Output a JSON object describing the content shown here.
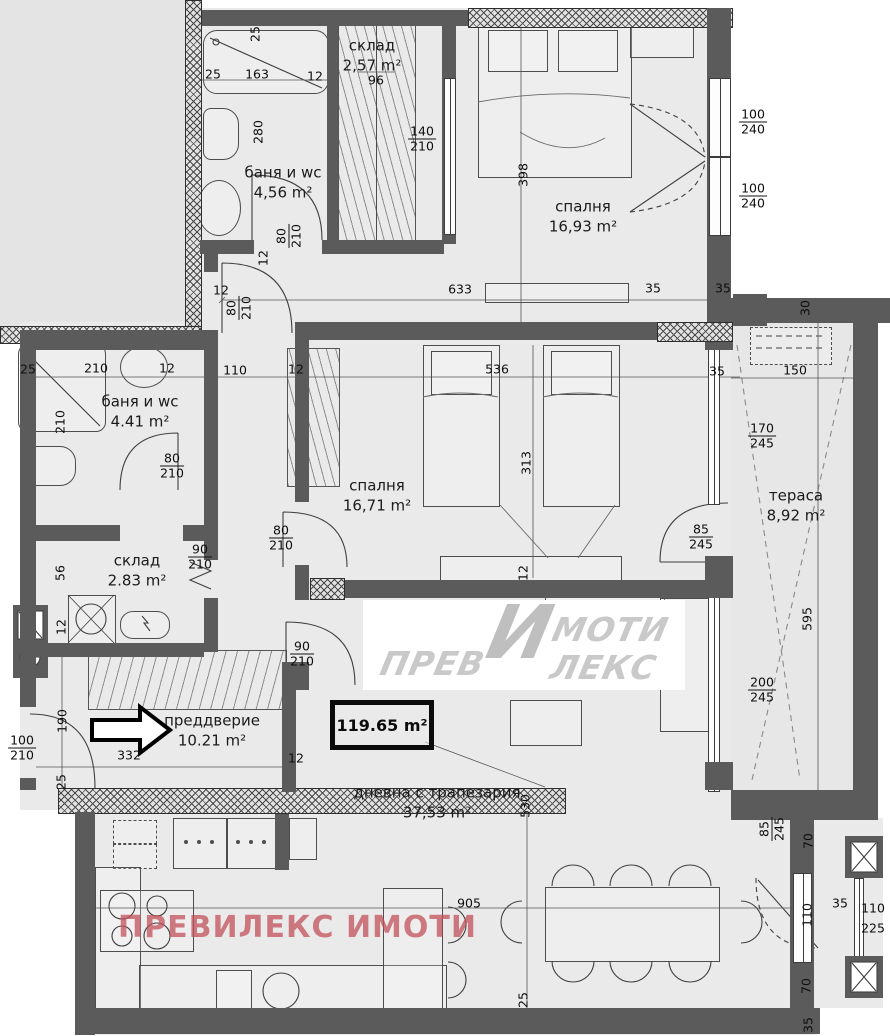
{
  "rooms": [
    {
      "label": "склад",
      "area": "2,57 m²"
    },
    {
      "label": "баня и wc",
      "area": "4,56 m²"
    },
    {
      "label": "спалня",
      "area": "16,93 m²"
    },
    {
      "label": "баня и wc",
      "area": "4.41 m²"
    },
    {
      "label": "спалня",
      "area": "16,71 m²"
    },
    {
      "label": "склад",
      "area": "2.83 m²"
    },
    {
      "label": "тераса",
      "area": "8,92 m²"
    },
    {
      "label": "преддверие",
      "area": "10.21 m²"
    },
    {
      "label": "дневна с трапезария",
      "area": "37,53 m²"
    }
  ],
  "badge": {
    "total_area": "119.65 m²"
  },
  "watermarks": {
    "logo": {
      "prev": "ПРЕВ",
      "big_i": "И",
      "moti": "МОТИ",
      "leks": "ЛЕКС"
    },
    "footer": "ПРЕВИЛЕКС ИМОТИ"
  },
  "colors": {
    "wall": "#5b5b5b",
    "floor": "#eaeaea",
    "outside": "#e4e4e4",
    "watermark_pink": "rgba(193,80,89,.75)",
    "logo_gray": "#c9c9c9"
  },
  "dims": [
    {
      "t": "25",
      "x": 213,
      "y": 74
    },
    {
      "t": "163",
      "x": 257,
      "y": 74
    },
    {
      "t": "12",
      "x": 315,
      "y": 76
    },
    {
      "t": "96",
      "x": 376,
      "y": 80
    },
    {
      "t": "25",
      "x": 255,
      "y": 34,
      "r": 1
    },
    {
      "t": "280",
      "x": 258,
      "y": 132,
      "r": 1
    },
    {
      "t": "12",
      "x": 263,
      "y": 258,
      "r": 1
    },
    {
      "t": "398",
      "x": 523,
      "y": 175,
      "r": 1
    },
    {
      "t": "633",
      "x": 460,
      "y": 289
    },
    {
      "t": "35",
      "x": 653,
      "y": 288
    },
    {
      "t": "35",
      "x": 723,
      "y": 288
    },
    {
      "t": "30",
      "x": 805,
      "y": 308,
      "r": 1
    },
    {
      "t": "12",
      "x": 221,
      "y": 290
    },
    {
      "t": "25",
      "x": 28,
      "y": 369
    },
    {
      "t": "210",
      "x": 96,
      "y": 368
    },
    {
      "t": "12",
      "x": 167,
      "y": 368
    },
    {
      "t": "110",
      "x": 235,
      "y": 370
    },
    {
      "t": "210",
      "x": 60,
      "y": 422,
      "r": 1
    },
    {
      "t": "12",
      "x": 296,
      "y": 369
    },
    {
      "t": "536",
      "x": 497,
      "y": 369
    },
    {
      "t": "35",
      "x": 717,
      "y": 371
    },
    {
      "t": "150",
      "x": 795,
      "y": 370
    },
    {
      "t": "313",
      "x": 526,
      "y": 463,
      "r": 1
    },
    {
      "t": "56",
      "x": 60,
      "y": 573,
      "r": 1
    },
    {
      "t": "12",
      "x": 523,
      "y": 573,
      "r": 1
    },
    {
      "t": "595",
      "x": 807,
      "y": 619,
      "r": 1
    },
    {
      "t": "12",
      "x": 61,
      "y": 627,
      "r": 1
    },
    {
      "t": "190",
      "x": 62,
      "y": 721,
      "r": 1
    },
    {
      "t": "332",
      "x": 129,
      "y": 755
    },
    {
      "t": "25",
      "x": 61,
      "y": 782,
      "r": 1
    },
    {
      "t": "12",
      "x": 296,
      "y": 758
    },
    {
      "t": "530",
      "x": 525,
      "y": 806,
      "r": 1
    },
    {
      "t": "905",
      "x": 469,
      "y": 903
    },
    {
      "t": "25",
      "x": 523,
      "y": 1000,
      "r": 1
    },
    {
      "t": "70",
      "x": 808,
      "y": 841,
      "r": 1
    },
    {
      "t": "110",
      "x": 807,
      "y": 915,
      "r": 1
    },
    {
      "t": "35",
      "x": 840,
      "y": 903
    },
    {
      "t": "110",
      "x": 873,
      "y": 908
    },
    {
      "t": "225",
      "x": 873,
      "y": 928
    },
    {
      "t": "70",
      "x": 806,
      "y": 986,
      "r": 1
    },
    {
      "t": "35",
      "x": 808,
      "y": 1025,
      "r": 1
    }
  ],
  "fracs": [
    {
      "a": "140",
      "b": "210",
      "x": 422,
      "y": 139
    },
    {
      "a": "100",
      "b": "240",
      "x": 753,
      "y": 122
    },
    {
      "a": "100",
      "b": "240",
      "x": 753,
      "y": 196
    },
    {
      "a": "80",
      "b": "210",
      "x": 289,
      "y": 236,
      "r": 1
    },
    {
      "a": "80",
      "b": "210",
      "x": 239,
      "y": 308,
      "r": 1
    },
    {
      "a": "80",
      "b": "210",
      "x": 172,
      "y": 466
    },
    {
      "a": "90",
      "b": "210",
      "x": 200,
      "y": 557
    },
    {
      "a": "80",
      "b": "210",
      "x": 281,
      "y": 538
    },
    {
      "a": "90",
      "b": "210",
      "x": 302,
      "y": 654
    },
    {
      "a": "170",
      "b": "245",
      "x": 762,
      "y": 436
    },
    {
      "a": "85",
      "b": "245",
      "x": 701,
      "y": 537
    },
    {
      "a": "200",
      "b": "245",
      "x": 762,
      "y": 690
    },
    {
      "a": "100",
      "b": "210",
      "x": 22,
      "y": 748
    },
    {
      "a": "85",
      "b": "245",
      "x": 772,
      "y": 829,
      "r": 1
    }
  ]
}
